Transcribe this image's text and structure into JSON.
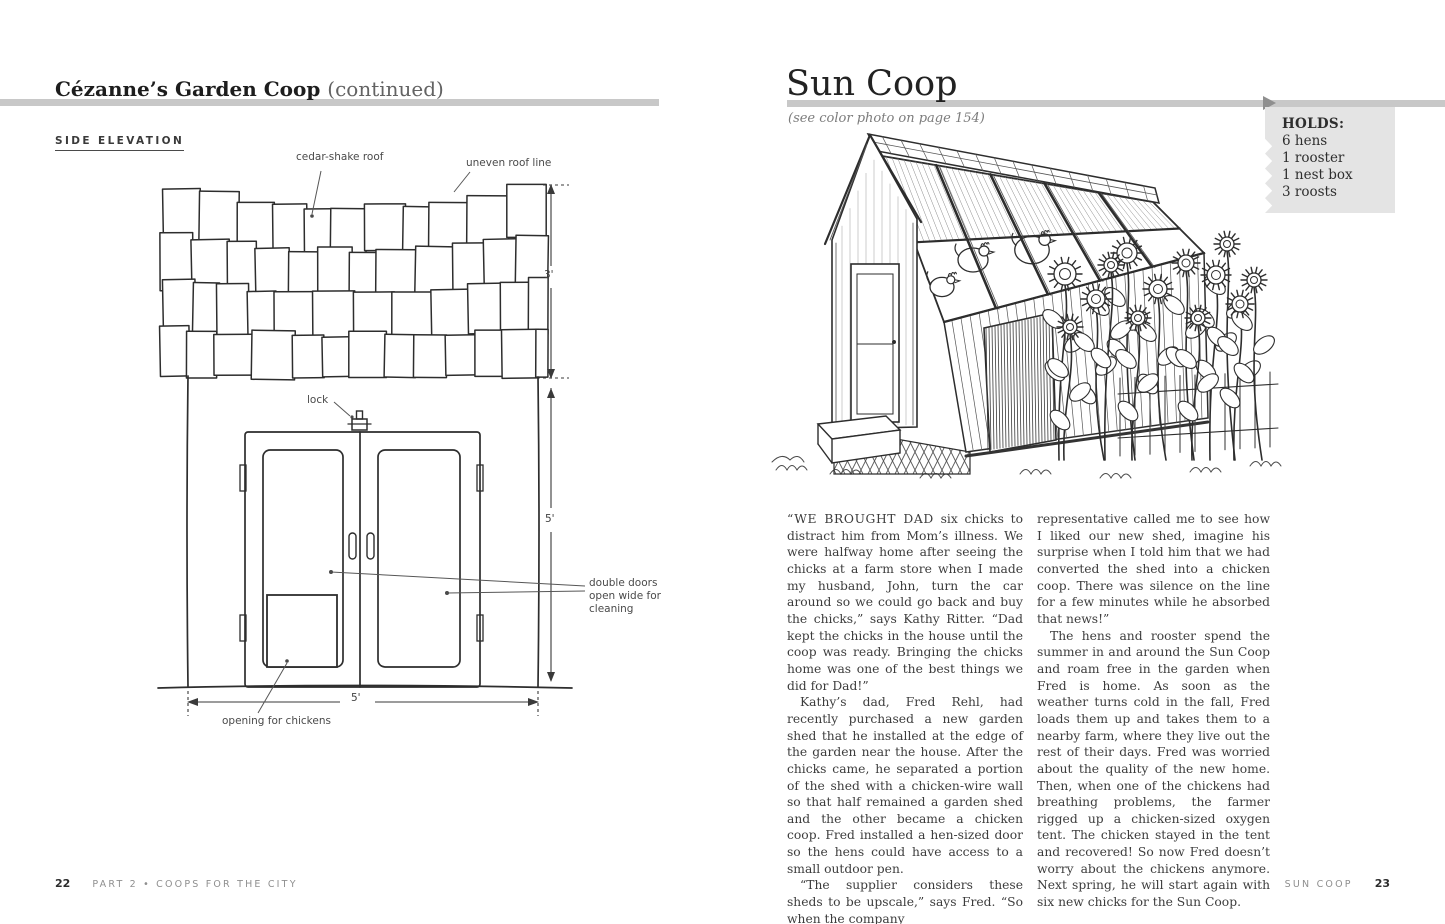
{
  "colors": {
    "rule_gray": "#c8c8c8",
    "holds_box_gray": "#e4e4e4",
    "arrow_gray": "#8f8f8f",
    "ink": "#2d2d2d",
    "body_text": "#3c3c3c",
    "label_text": "#4a4a4a",
    "muted_gray": "#8f8f8f"
  },
  "left_page": {
    "title": "Cézanne’s Garden Coop",
    "title_suffix": "(continued)",
    "section_label": "SIDE ELEVATION",
    "diagram_labels": {
      "cedar_shake_roof": "cedar-shake roof",
      "uneven_roof_line": "uneven roof line",
      "lock": "lock",
      "double_doors": "double doors open wide for cleaning",
      "opening_for_chickens": "opening for chickens",
      "roof_height": "3'",
      "door_height": "5'",
      "width": "5'"
    },
    "footer": {
      "page_number": "22",
      "running_title": "PART 2 • COOPS FOR THE CITY"
    }
  },
  "right_page": {
    "title": "Sun Coop",
    "subtitle": "(see color photo on page 154)",
    "holds_box": {
      "heading": "HOLDS:",
      "items": [
        "6 hens",
        "1 rooster",
        "1 nest box",
        "3 roosts"
      ]
    },
    "article": {
      "col1": [
        {
          "lead": "“WE BROUGHT DAD",
          "text": " six chicks to distract him from Mom’s illness. We were halfway home after seeing the chicks at a farm store when I made my husband, John, turn the car around so we could go back and buy the chicks,” says Kathy Ritter. “Dad kept the chicks in the house until the coop was ready. Bringing the chicks home was one of the best things we did for Dad!”"
        },
        {
          "text": "Kathy’s dad, Fred Rehl, had recently purchased a new garden shed that he installed at the edge of the garden near the house. After the chicks came, he separated a portion of the shed with a chicken-wire wall so that half remained a garden shed and the other became a chicken coop. Fred installed a hen-sized door so the hens could have access to a small outdoor pen."
        },
        {
          "text": "“The supplier considers these sheds to be upscale,” says Fred. “So when the company"
        }
      ],
      "col2": [
        {
          "text": "representative called me to see how I liked our new shed, imagine his surprise when I told him that we had converted the shed into a chicken coop. There was silence on the line for a few minutes while he absorbed that news!”"
        },
        {
          "text": "The hens and rooster spend the summer in and around the Sun Coop and roam free in the garden when Fred is home. As soon as the weather turns cold in the fall, Fred loads them up and takes them to a nearby farm, where they live out the rest of their days. Fred was worried about the quality of the new home. Then, when one of the chickens had breathing problems, the farmer rigged up a chicken-sized oxygen tent. The chicken stayed in the tent and recovered! So now Fred doesn’t worry about the chickens anymore. Next spring, he will start again with six new chicks for the Sun Coop."
        }
      ]
    },
    "footer": {
      "running_title": "SUN COOP",
      "page_number": "23"
    }
  }
}
